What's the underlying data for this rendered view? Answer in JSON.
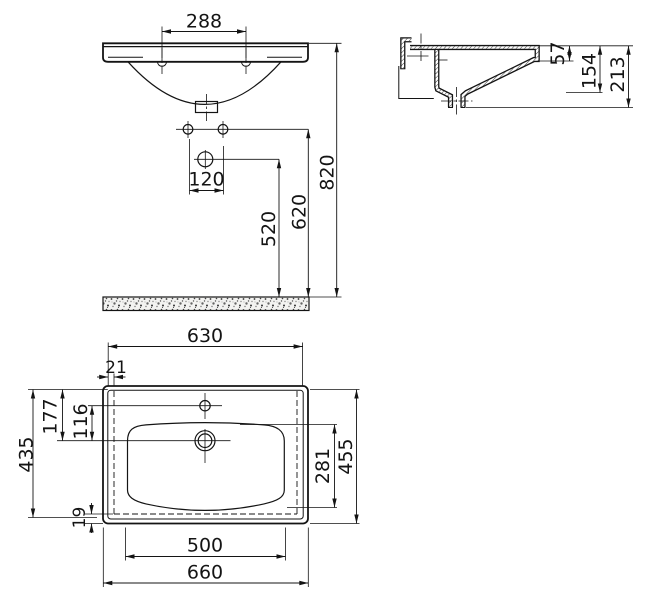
{
  "drawing": {
    "title": "washbasin-technical-drawing",
    "line_color": "#141414",
    "front": {
      "tap_hole_spacing": "288",
      "fixing_hole_spacing": "120",
      "drain_height": "520",
      "fixing_hole_height": "620",
      "rim_height": "820"
    },
    "side": {
      "front_edge_depth": "57",
      "basin_depth": "154",
      "overall_depth": "213"
    },
    "plan": {
      "inner_width": "630",
      "edge_gap_side": "21",
      "back_to_drain": "177",
      "faucet_to_drain": "116",
      "bowl_length": "281",
      "overall_depth": "455",
      "inner_depth": "435",
      "edge_gap_bottom": "19",
      "bowl_width": "500",
      "overall_width": "660"
    }
  }
}
